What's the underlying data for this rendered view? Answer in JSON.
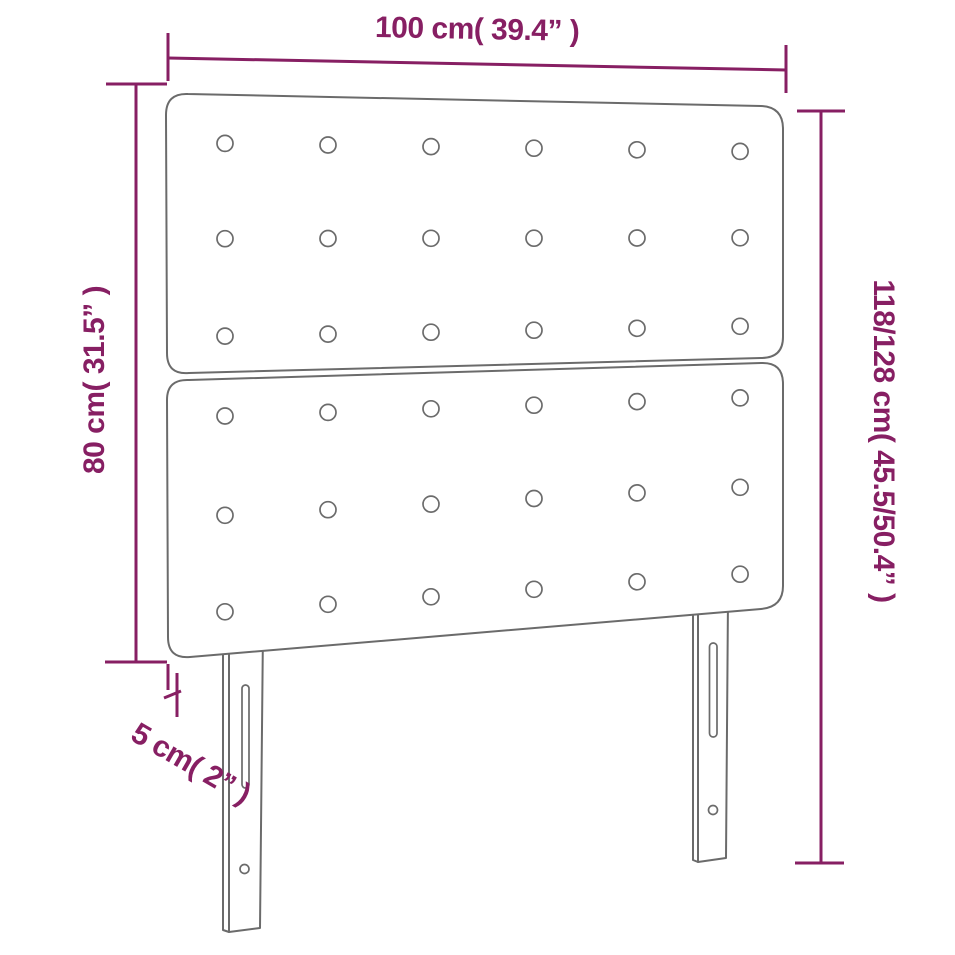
{
  "diagram": {
    "type": "product-dimension-diagram",
    "product": "tufted-headboard-with-two-panels-and-two-legs"
  },
  "dimensions": {
    "width": {
      "label": "100 cm( 39.4” )"
    },
    "panel_height": {
      "label": "80 cm( 31.5” )"
    },
    "total_height": {
      "label": "118/128 cm( 45.5/50.4” )"
    },
    "depth": {
      "label": "5 cm( 2” )"
    }
  },
  "structure": {
    "panels": 2,
    "button_rows_per_panel": 3,
    "button_columns": 6,
    "legs": 2,
    "slots_per_leg": 1,
    "holes_per_leg": 1
  },
  "colors": {
    "dimension": "#871F63",
    "outline": "#6B6B6B",
    "background": "#FFFFFF"
  }
}
